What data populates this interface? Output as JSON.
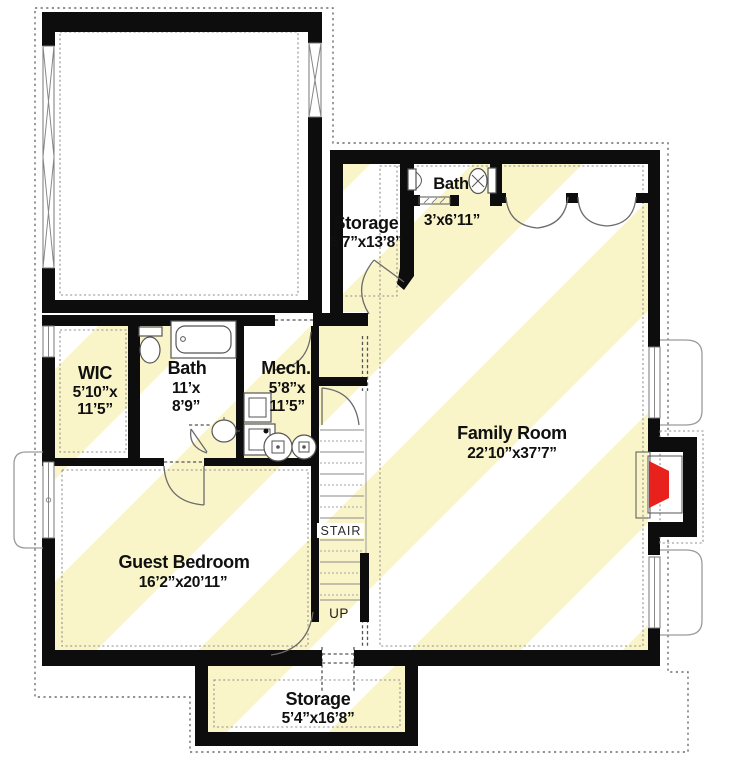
{
  "rooms": {
    "storage_top": {
      "name": "Storage",
      "dims": "6’7”x13’8”"
    },
    "bath_top": {
      "name": "Bath",
      "dims": "3’x6’11”"
    },
    "family": {
      "name": "Family Room",
      "dims": "22’10”x37’7”"
    },
    "wic": {
      "name": "WIC",
      "dims1": "5’10”x",
      "dims2": "11’5”"
    },
    "bath_mid": {
      "name": "Bath",
      "dims1": "11’x",
      "dims2": "8’9”"
    },
    "mech": {
      "name": "Mech.",
      "dims1": "5’8”x",
      "dims2": "11’5”"
    },
    "guest": {
      "name": "Guest Bedroom",
      "dims": "16’2”x20’11”"
    },
    "storage_bottom": {
      "name": "Storage",
      "dims": "5’4”x16’8”"
    }
  },
  "stairs": {
    "label": "STAIR",
    "direction": "UP"
  },
  "colors": {
    "stripe": "#faf5c9",
    "wall": "#0d0d0d",
    "fireplace": "#e8211c",
    "line_gray": "#777777"
  }
}
